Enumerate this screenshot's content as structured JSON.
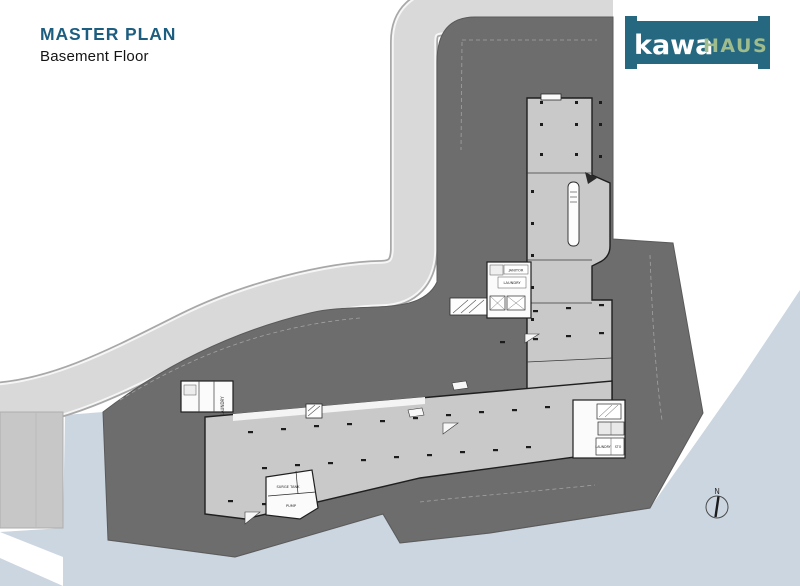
{
  "page": {
    "title": "MASTER PLAN",
    "subtitle": "Basement Floor"
  },
  "logo": {
    "word_primary": "kawa",
    "word_secondary": "HAUS",
    "bg_color": "#26687f",
    "primary_color": "#ffffff",
    "secondary_color": "#9fbc8d"
  },
  "compass": {
    "north_label": "N"
  },
  "plan_labels": {
    "janitor": "JANITOR",
    "laundry": "LAUNDRY",
    "laundry_vertical": "LAUNDRY",
    "surge_tank": "SURGE TANK",
    "pump": "PUMP",
    "laundry_right": "LAUNDRY",
    "sto": "STO"
  },
  "colors": {
    "title_text": "#1d5e80",
    "site_dark": "#6d6d6d",
    "road": "#d9d9d9",
    "road_edge": "#a8a8a8",
    "water": "#ccd6e0",
    "building": "#c9c9c9",
    "building_outline": "#1f1f1f",
    "parcel": "#c7c7c7",
    "room_white": "#fbfbfb"
  }
}
